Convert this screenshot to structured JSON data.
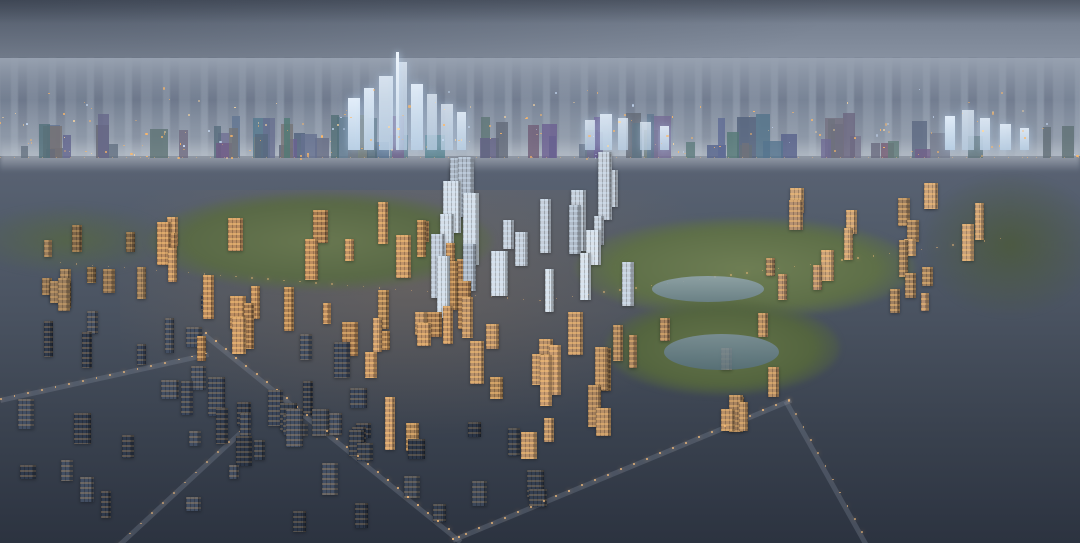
{
  "labels": {
    "park_tod": {
      "main": "南大路 PARK-TOD",
      "suffix": "(在建中)",
      "subtitle": "约250米城市新地标"
    },
    "zhonghuan_ludao": {
      "main": "中环麓岛"
    },
    "xigu_park": {
      "main": "溪谷公园",
      "suffix": "(在建中)"
    },
    "fengxiang_tod": {
      "main": "丰翔路TOD",
      "suffix": "(在建中)"
    },
    "nanda_smart_city": {
      "main": "南大智慧城"
    },
    "nanda_central_park": {
      "main": "南大中央公园",
      "suffix": "(在建中)"
    },
    "zoumatang_park": {
      "main": "走马塘公园",
      "suffix": "(在建中)"
    }
  },
  "footer": {
    "disclaimer": "南大智慧城效果图，仅供参考"
  },
  "watermark": {
    "text": "搜狐号@搜狐焦点嘉峪关站"
  },
  "colors": {
    "label_green_bg": "#7d9363",
    "brand_green_text": "#2f7d4a",
    "warm_light": "#ffb866",
    "sky_top": "#6e7888"
  }
}
